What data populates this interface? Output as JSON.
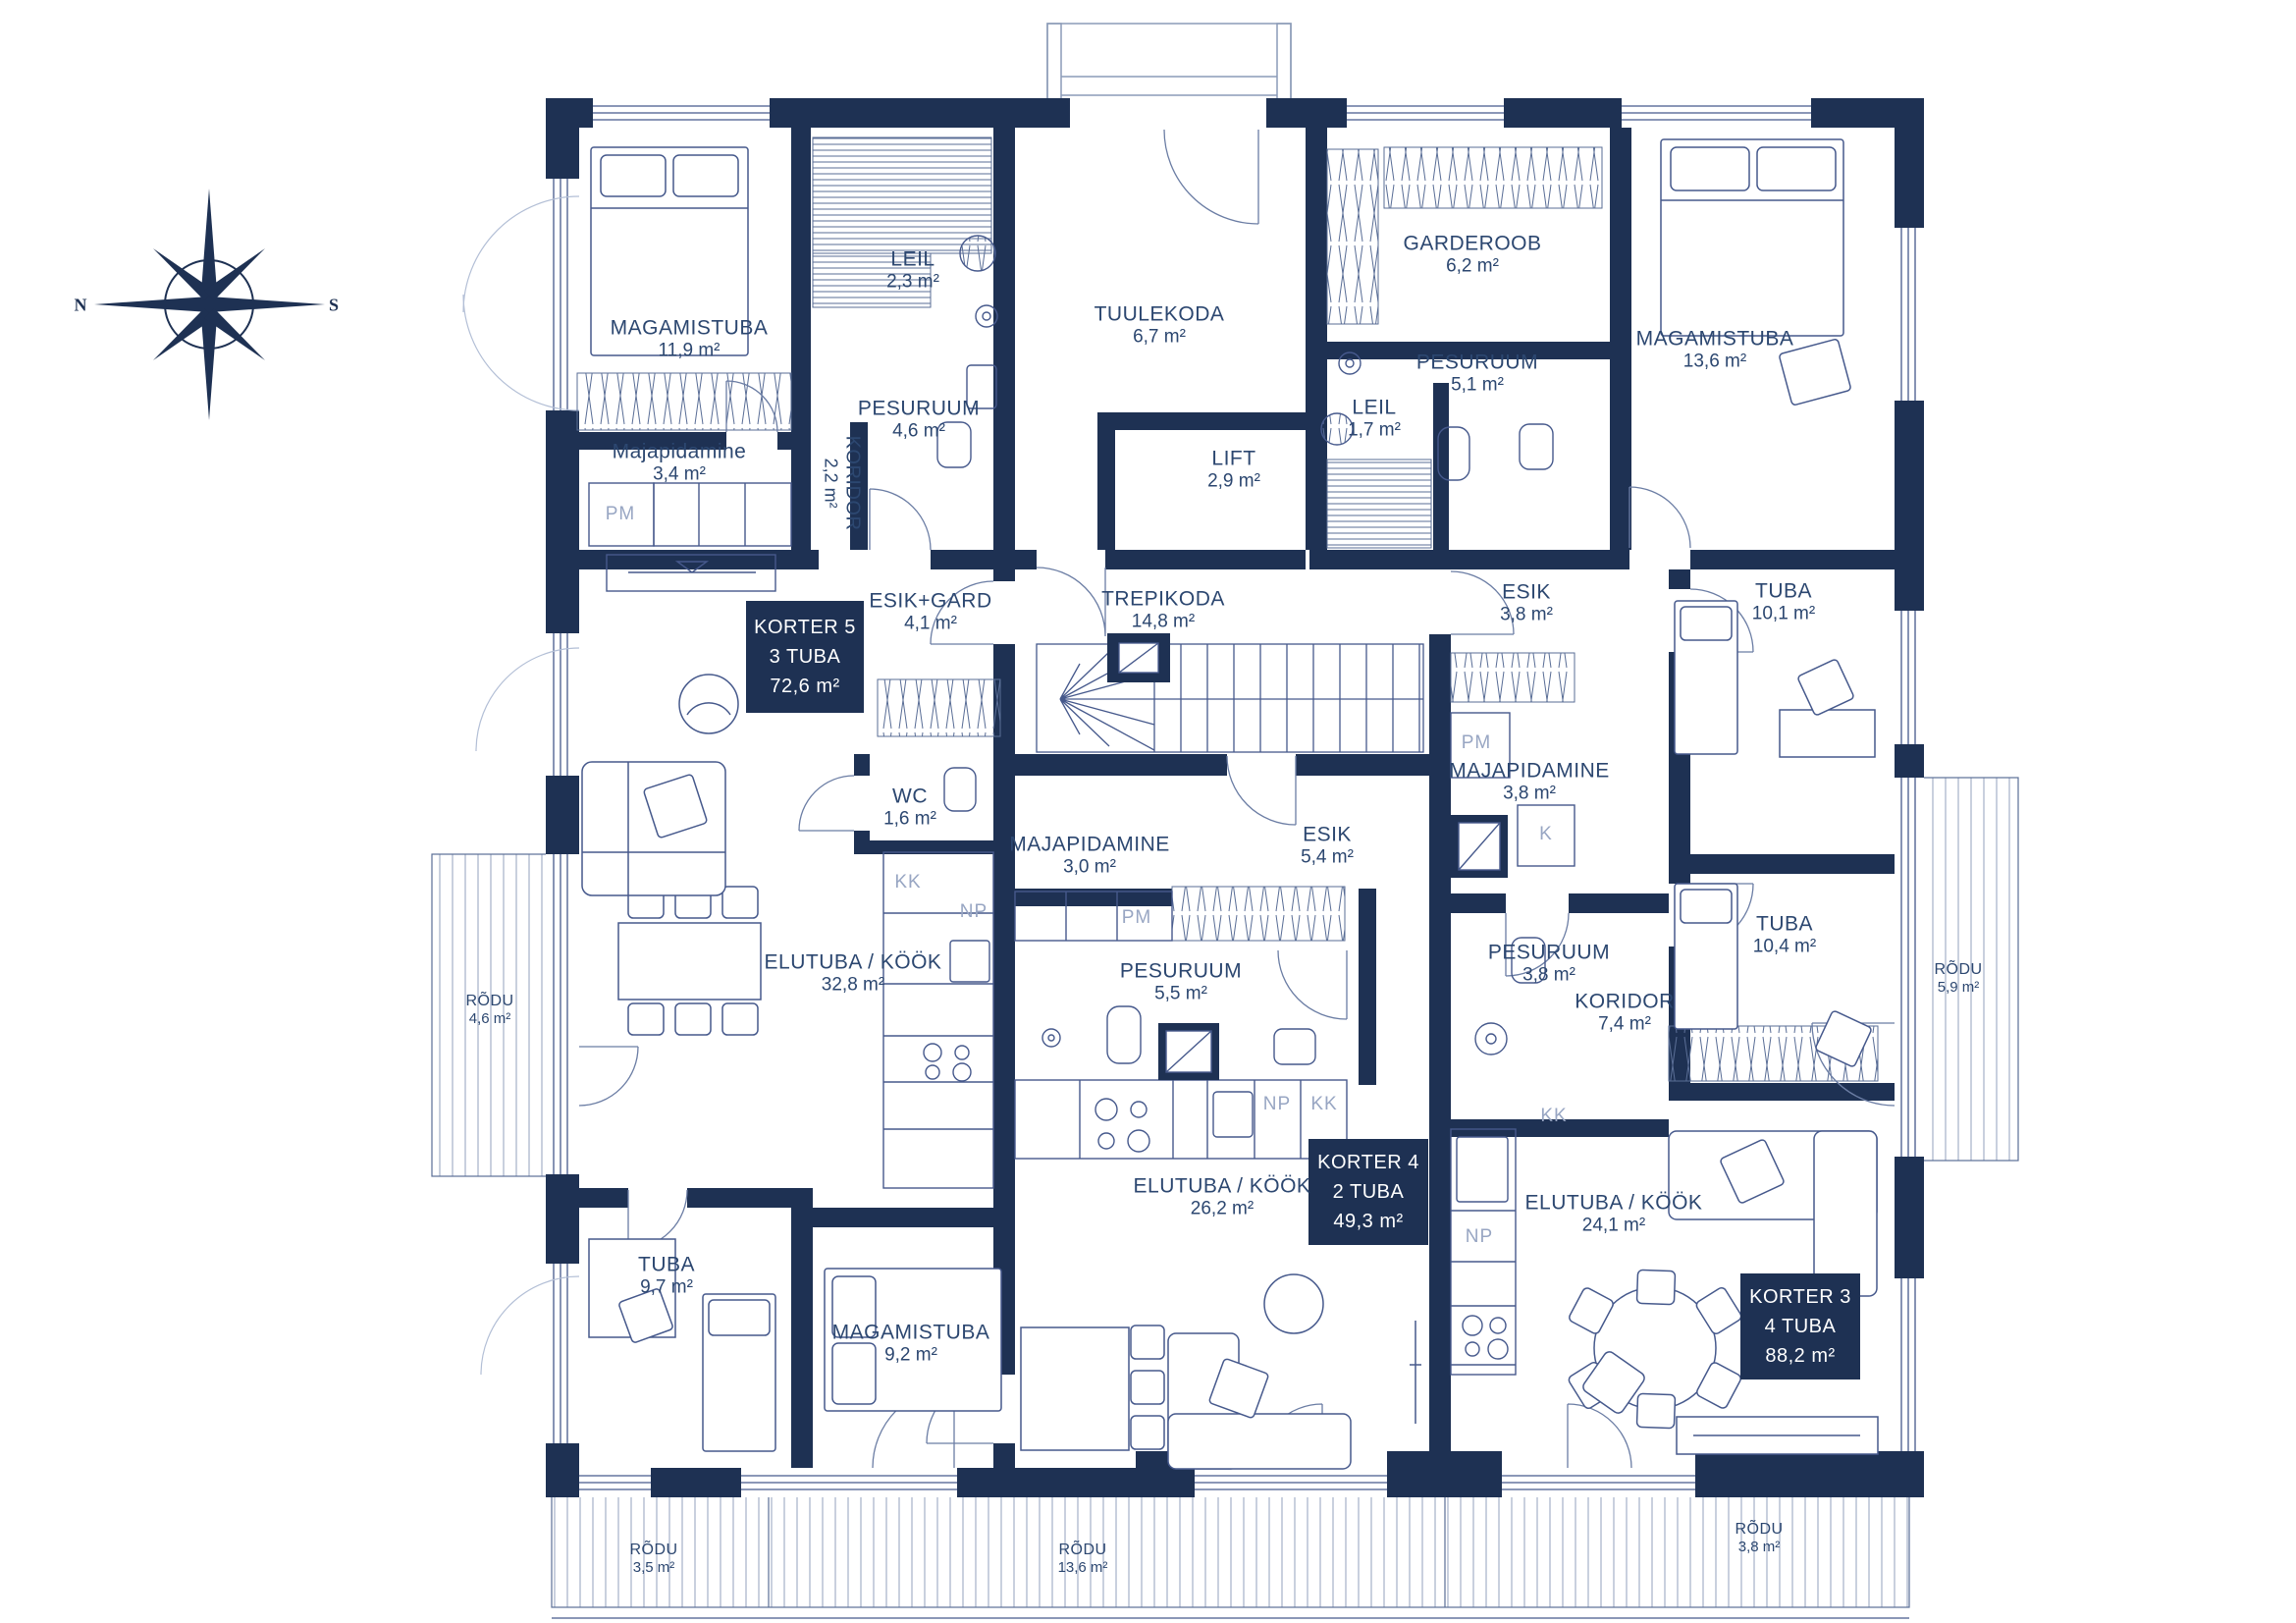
{
  "compass": {
    "north": "N",
    "south": "S"
  },
  "apartments": [
    {
      "title": "KORTER 5",
      "rooms": "3 TUBA",
      "area": "72,6 m²"
    },
    {
      "title": "KORTER 4",
      "rooms": "2 TUBA",
      "area": "49,3 m²"
    },
    {
      "title": "KORTER 3",
      "rooms": "4 TUBA",
      "area": "88,2 m²"
    }
  ],
  "rooms": [
    {
      "name": "MAGAMISTUBA",
      "area": "11,9 m²"
    },
    {
      "name": "LEIL",
      "area": "2,3 m²"
    },
    {
      "name": "PESURUUM",
      "area": "4,6 m²"
    },
    {
      "name": "Majapidamine",
      "area": "3,4 m²"
    },
    {
      "name": "KORIDOR",
      "area": "2,2 m²"
    },
    {
      "name": "TUULEKODA",
      "area": "6,7 m²"
    },
    {
      "name": "LIFT",
      "area": "2,9 m²"
    },
    {
      "name": "GARDEROOB",
      "area": "6,2 m²"
    },
    {
      "name": "PESURUUM",
      "area": "5,1 m²"
    },
    {
      "name": "LEIL",
      "area": "1,7 m²"
    },
    {
      "name": "MAGAMISTUBA",
      "area": "13,6 m²"
    },
    {
      "name": "ESIK",
      "area": "3,8 m²"
    },
    {
      "name": "TUBA",
      "area": "10,1 m²"
    },
    {
      "name": "ESIK+GARD",
      "area": "4,1 m²"
    },
    {
      "name": "TREPIKODA",
      "area": "14,8 m²"
    },
    {
      "name": "WC",
      "area": "1,6 m²"
    },
    {
      "name": "MAJAPIDAMINE",
      "area": "3,0 m²"
    },
    {
      "name": "ESIK",
      "area": "5,4 m²"
    },
    {
      "name": "MAJAPIDAMINE",
      "area": "3,8 m²"
    },
    {
      "name": "PESURUUM",
      "area": "5,5 m²"
    },
    {
      "name": "ELUTUBA / KÖÖK",
      "area": "32,8 m²"
    },
    {
      "name": "PESURUUM",
      "area": "3,8 m²"
    },
    {
      "name": "KORIDOR",
      "area": "7,4 m²"
    },
    {
      "name": "TUBA",
      "area": "10,4 m²"
    },
    {
      "name": "ELUTUBA / KÖÖK",
      "area": "26,2 m²"
    },
    {
      "name": "ELUTUBA / KÖÖK",
      "area": "24,1 m²"
    },
    {
      "name": "TUBA",
      "area": "9,7 m²"
    },
    {
      "name": "MAGAMISTUBA",
      "area": "9,2 m²"
    },
    {
      "name": "RÕDU",
      "area": "4,6 m²"
    },
    {
      "name": "RÕDU",
      "area": "5,9 m²"
    },
    {
      "name": "RÕDU",
      "area": "3,5 m²"
    },
    {
      "name": "RÕDU",
      "area": "13,6 m²"
    },
    {
      "name": "RÕDU",
      "area": "3,8 m²"
    }
  ],
  "fixtures": [
    {
      "label": "PM"
    },
    {
      "label": "KK"
    },
    {
      "label": "NP"
    },
    {
      "label": "PM"
    },
    {
      "label": "NP"
    },
    {
      "label": "KK"
    },
    {
      "label": "PM"
    },
    {
      "label": "K"
    },
    {
      "label": "KK"
    },
    {
      "label": "NP"
    }
  ],
  "colors": {
    "wall": "#1E3153",
    "line": "#46598C",
    "light_line": "#8C9BB8",
    "text": "#2C4770",
    "fixture_text": "#98A6C3"
  }
}
